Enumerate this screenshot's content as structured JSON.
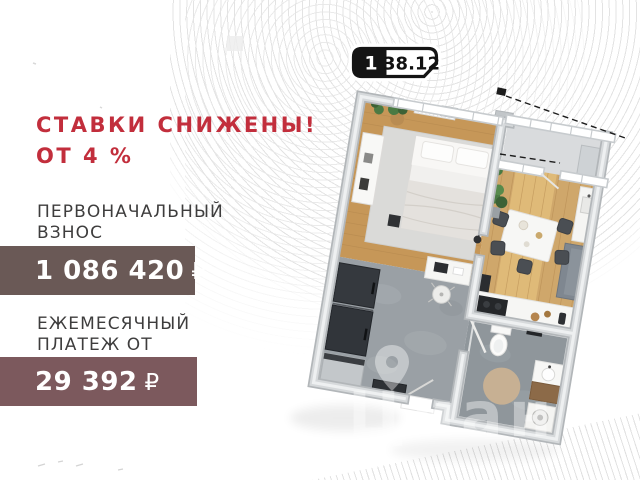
{
  "promo": {
    "line1": "СТАВКИ СНИЖЕНЫ!",
    "line2": "ОТ 4 %"
  },
  "down_payment": {
    "label1": "ПЕРВОНАЧАЛЬНЫЙ",
    "label2": "ВЗНОС",
    "amount": "1 086 420",
    "currency": "₽"
  },
  "monthly_payment": {
    "label1": "ЕЖЕМЕСЯЧНЫЙ",
    "label2": "ПЛАТЕЖ ОТ",
    "amount": "29 392",
    "currency": "₽"
  },
  "badge": {
    "rooms": "1",
    "area": "38.12"
  },
  "watermark": {
    "brand": "Циан"
  },
  "colors": {
    "accent_red": "#c22e3c",
    "text_dark": "#3e3d3d",
    "banner_down_payment": "#6a5956",
    "banner_monthly": "#7c595d",
    "badge_black": "#141414",
    "wood_bedroom": "#c69758",
    "wood_living": "#cfa76b",
    "sunlight": "#ecca83",
    "tile_hall": "#9aa0a5",
    "tile_bath": "#8f969b",
    "balcony_floor": "#d9dbdd",
    "rug": "#dadad8",
    "dark_furniture": "#34383d",
    "plant_green": "#4a7a43"
  }
}
